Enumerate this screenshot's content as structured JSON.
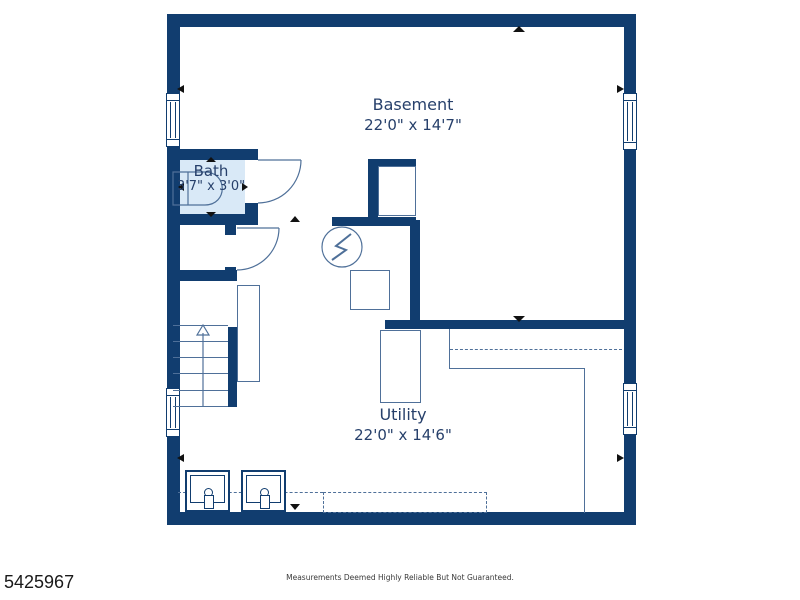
{
  "plan": {
    "rooms": [
      {
        "name": "Basement",
        "dimensions": "22'0\" x 14'7\""
      },
      {
        "name": "Bath",
        "dimensions": "3'7\" x 3'0\""
      },
      {
        "name": "Utility",
        "dimensions": "22'0\" x 14'6\""
      }
    ]
  },
  "footer": {
    "listing_id": "5425967",
    "disclaimer": "Measurements Deemed Highly Reliable But Not Guaranteed."
  },
  "theme": {
    "wall_color": "#113d6f",
    "bath_fill_color": "#d9e9f7",
    "label_color": "#27406b",
    "thin_line_color": "#4f7099",
    "marker_color": "#111111",
    "background": "#ffffff"
  }
}
